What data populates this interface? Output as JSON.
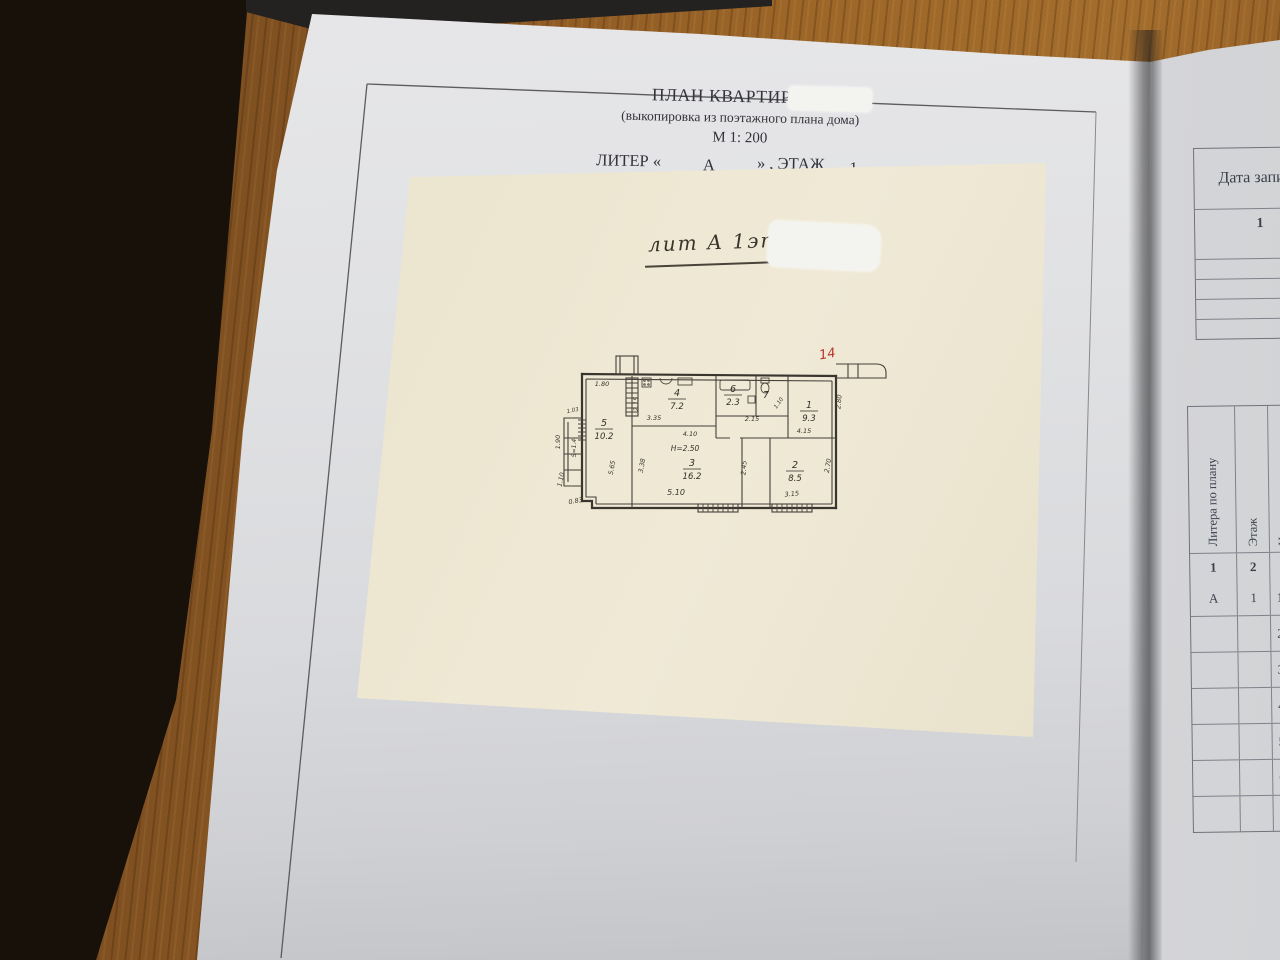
{
  "document_page": {
    "title": "ПЛАН КВАРТИРЫ №",
    "subtitle": "(выкопировка из поэтажного плана дома)",
    "scale": "М 1: 200",
    "liter": {
      "prefix": "ЛИТЕР «",
      "liter_value": "А",
      "middle": "» , ЭТАЖ",
      "floor_value": "1"
    }
  },
  "plan_sheet": {
    "handwritten_note": "лит А 1эт.",
    "apartment_number_red": {
      "t": "14",
      "x": 276,
      "y": 20
    }
  },
  "floor_plan": {
    "height_note": "Н=2.50",
    "rooms": [
      {
        "num": "5",
        "area": "10.2",
        "x": 52,
        "y": 88
      },
      {
        "num": "4",
        "area": "7.2",
        "x": 125,
        "y": 58
      },
      {
        "num": "6",
        "area": "2.3",
        "x": 181,
        "y": 54
      },
      {
        "num": "7",
        "area": "",
        "x": 214,
        "y": 60
      },
      {
        "num": "1",
        "area": "9.3",
        "x": 257,
        "y": 70
      },
      {
        "num": "3",
        "area": "16.2",
        "x": 140,
        "y": 128
      },
      {
        "num": "2",
        "area": "8.5",
        "x": 243,
        "y": 130
      }
    ],
    "dims": [
      {
        "t": "1.80",
        "x": 50,
        "y": 48,
        "r": 0
      },
      {
        "t": "1.03",
        "x": 21,
        "y": 74,
        "r": -12,
        "fs": 5.5
      },
      {
        "t": "1.90",
        "x": 8,
        "y": 104,
        "r": -90
      },
      {
        "t": "S=1.4",
        "x": 24,
        "y": 110,
        "r": -90,
        "fs": 6
      },
      {
        "t": "1.10",
        "x": 11,
        "y": 142,
        "r": -78
      },
      {
        "t": "0.83",
        "x": 24,
        "y": 165,
        "r": -10
      },
      {
        "t": "5.65",
        "x": 62,
        "y": 130,
        "r": -80
      },
      {
        "t": "2.15",
        "x": 86,
        "y": 66,
        "r": -90
      },
      {
        "t": "3.35",
        "x": 102,
        "y": 82,
        "r": 0
      },
      {
        "t": "2.15",
        "x": 200,
        "y": 83,
        "r": 0
      },
      {
        "t": "1.10",
        "x": 228,
        "y": 66,
        "r": -55,
        "fs": 5.5
      },
      {
        "t": "4.15",
        "x": 252,
        "y": 95,
        "r": 0
      },
      {
        "t": "2.80",
        "x": 289,
        "y": 64,
        "r": -85
      },
      {
        "t": "4.10",
        "x": 138,
        "y": 98,
        "r": 0
      },
      {
        "t": "Н=2.50",
        "x": 133,
        "y": 113,
        "r": 0,
        "fs": 7.5
      },
      {
        "t": "3.38",
        "x": 92,
        "y": 128,
        "r": -80
      },
      {
        "t": "5.10",
        "x": 124,
        "y": 157,
        "r": 0,
        "fs": 8
      },
      {
        "t": "2.45",
        "x": 194,
        "y": 130,
        "r": -85
      },
      {
        "t": "2.70",
        "x": 278,
        "y": 128,
        "r": -80
      },
      {
        "t": "3.15",
        "x": 240,
        "y": 158,
        "r": -5
      }
    ]
  },
  "right_page": {
    "records_table": {
      "header": "Дата запи",
      "number_row": "1",
      "empty_row_count": 5
    },
    "rooms_table": {
      "headers": [
        "Литера по плану",
        "Этаж",
        "Номер комнаты"
      ],
      "column_numbers": [
        "1",
        "2",
        ""
      ],
      "rows": [
        [
          "А",
          "1",
          "1"
        ],
        [
          "",
          "",
          "2"
        ],
        [
          "",
          "",
          "3"
        ],
        [
          "",
          "",
          "4"
        ],
        [
          "",
          "",
          "5"
        ],
        [
          "",
          "",
          "6"
        ],
        [
          "",
          "",
          "7"
        ]
      ]
    }
  },
  "colors": {
    "wood": "#8a5723",
    "dark_floor": "#17110a",
    "page_white": "#dfe0e3",
    "sheet_cream": "#ece6d0",
    "ink": "#3a362f",
    "red_mark": "#b5342a"
  }
}
